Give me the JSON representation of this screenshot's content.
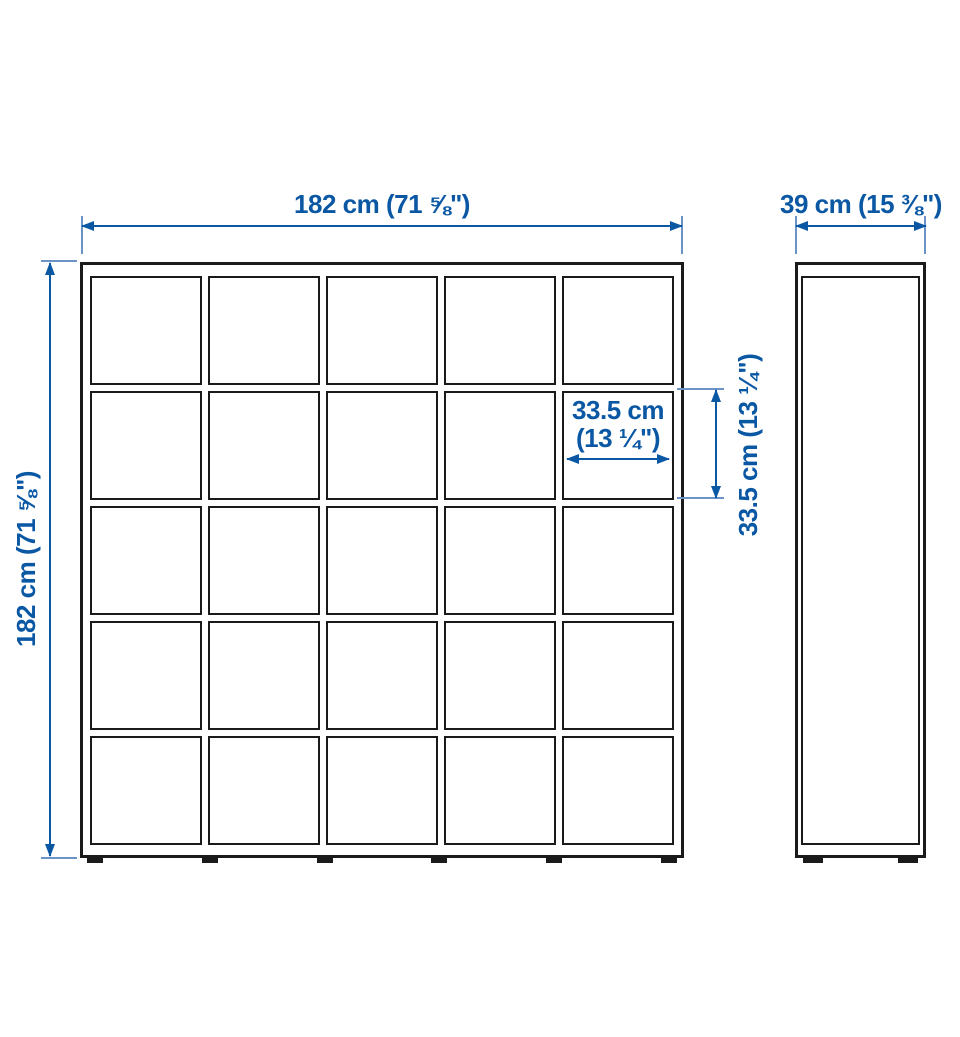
{
  "colors": {
    "accent": "#0a57a4",
    "tick": "#6c93c8",
    "line": "#1a1a1a",
    "background": "#ffffff"
  },
  "front_view": {
    "grid_rows": 5,
    "grid_columns": 5,
    "feet_count": 6,
    "width_dim_label": "182 cm (71 ⅝\")",
    "height_dim_label": "182 cm (71 ⅝\")",
    "cell_width_dim": {
      "line1": "33.5 cm",
      "line2": "(13 ¼\")"
    },
    "cell_height_dim_label": "33.5 cm (13 ¼\")"
  },
  "side_view": {
    "feet_count": 2,
    "depth_dim_label": "39 cm (15 ⅜\")"
  }
}
